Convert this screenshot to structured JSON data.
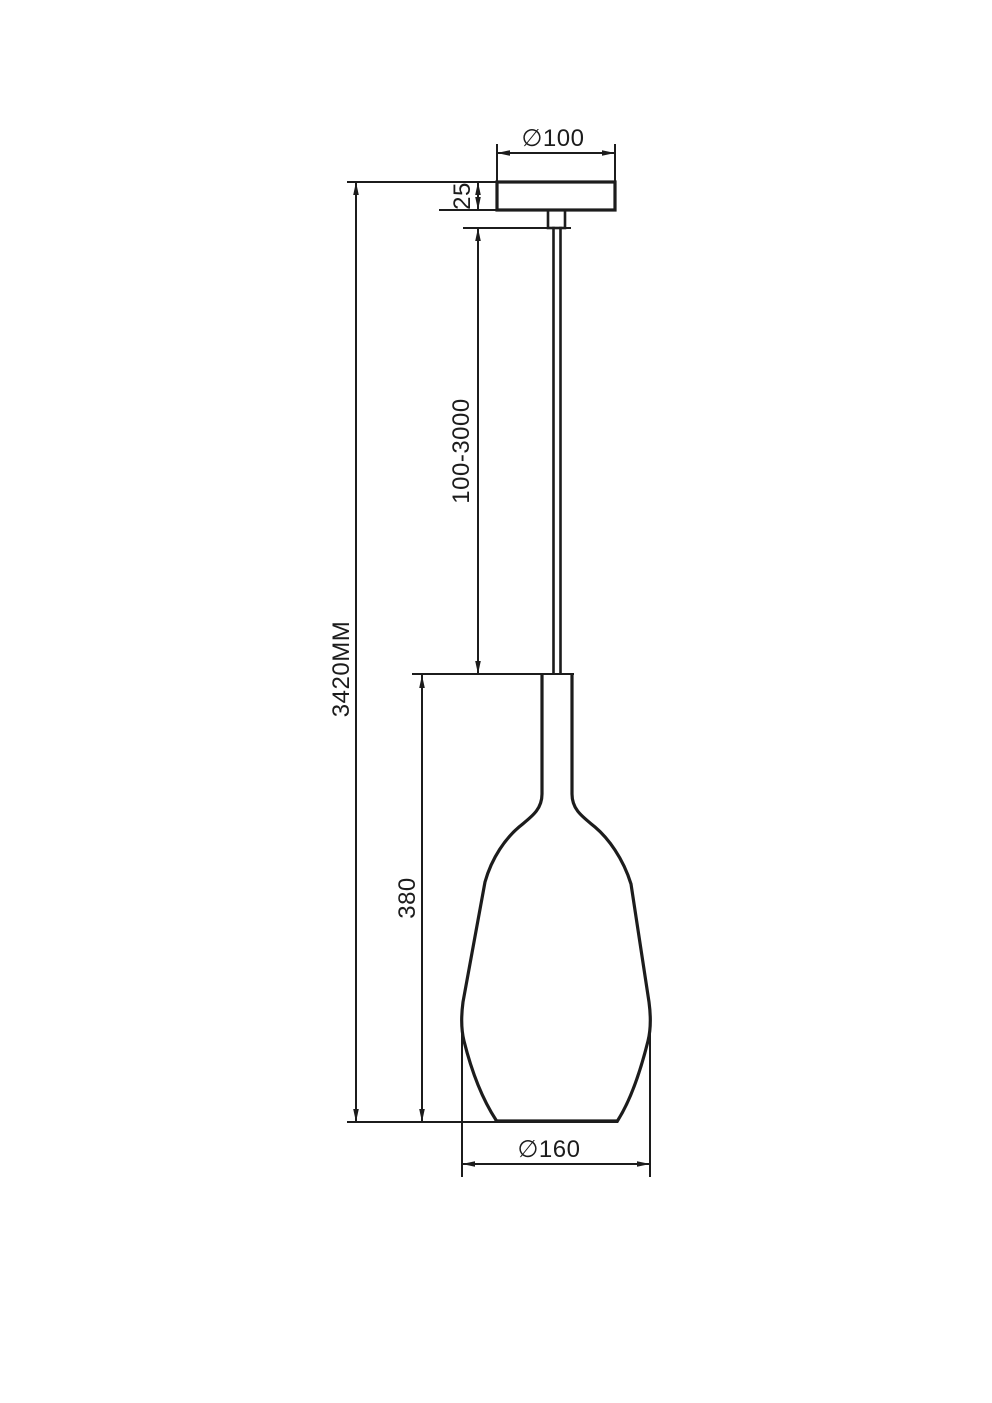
{
  "drawing": {
    "description": "pendant lamp technical dimension drawing",
    "background_color": "#ffffff",
    "line_color": "#1c1c1c",
    "labels": {
      "canopy_diameter": "∅100",
      "canopy_height": "25",
      "suspension_length": "100-3000",
      "overall_height": "3420MM",
      "shade_height": "380",
      "shade_diameter": "∅160"
    }
  }
}
